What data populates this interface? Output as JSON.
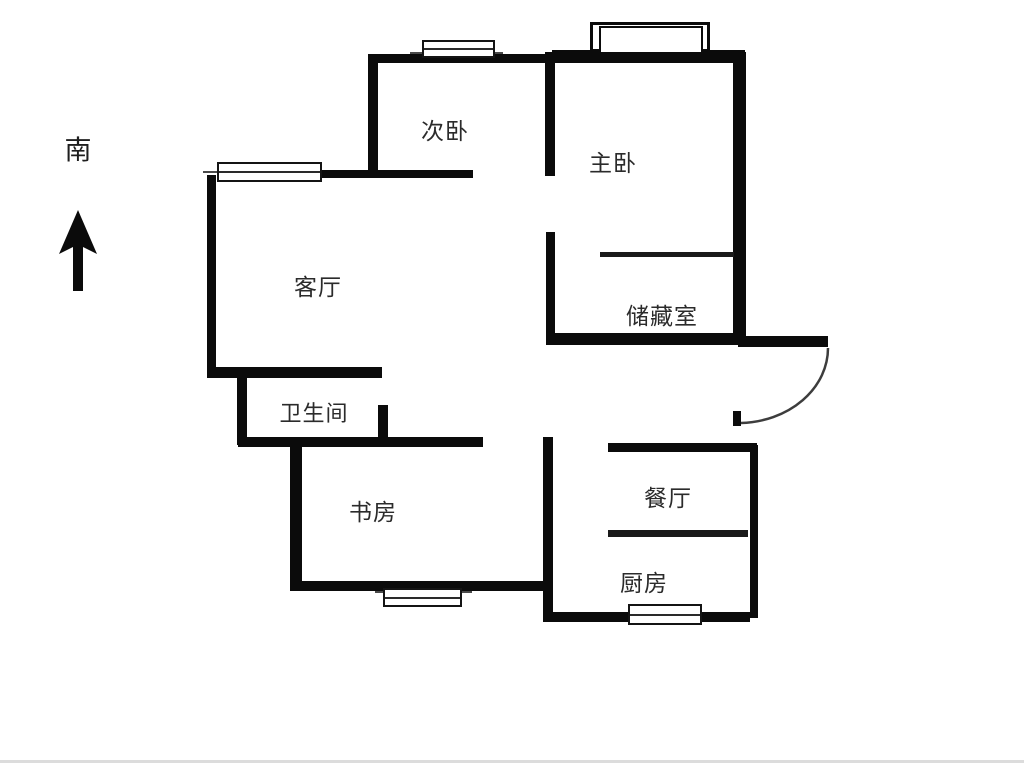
{
  "compass": {
    "label": "南"
  },
  "rooms": {
    "bedroom2": {
      "label": "次卧"
    },
    "master_bedroom": {
      "label": "主卧"
    },
    "living_room": {
      "label": "客厅"
    },
    "storage": {
      "label": "储藏室"
    },
    "bathroom": {
      "label": "卫生间"
    },
    "study": {
      "label": "书房"
    },
    "dining_room": {
      "label": "餐厅"
    },
    "kitchen": {
      "label": "厨房"
    }
  },
  "colors": {
    "wall": "#0b0b0b",
    "text": "#2b2b2b",
    "door_arc": "#3d3d3d",
    "baseline": "#dcdcdc"
  }
}
